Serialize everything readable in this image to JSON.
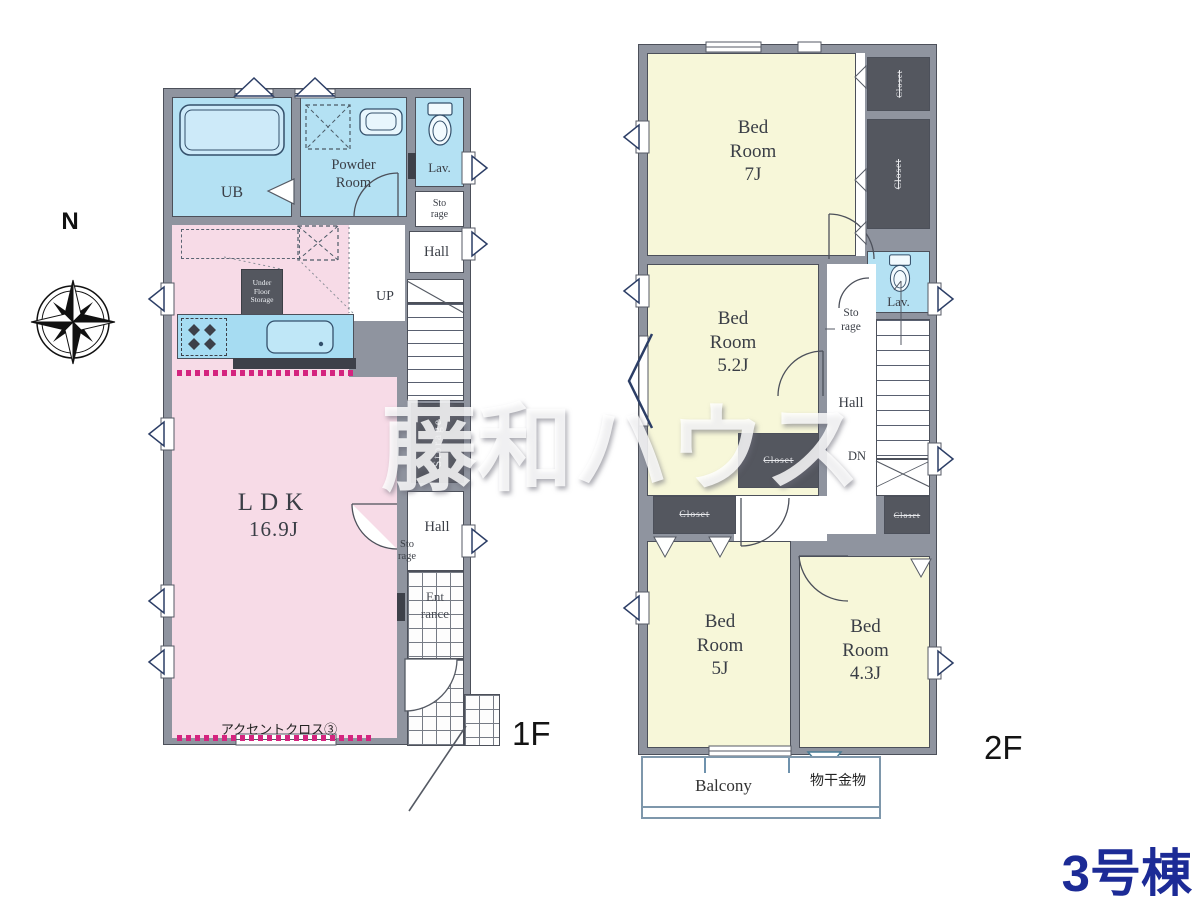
{
  "compass": {
    "north_label": "N"
  },
  "watermark": {
    "text": "藤和ハウス"
  },
  "title": {
    "text": "3号棟"
  },
  "colors": {
    "ldk_pink": "#f7dbe7",
    "wet_area_blue": "#b4e1f3",
    "bedroom_yellow": "#f7f7d9",
    "closet_dark": "#54575f",
    "wall_gray": "#8f949f",
    "accent_magenta": "#d4247f",
    "title_navy": "#1c2b96",
    "balcony_outline": "#7e97ab"
  },
  "floor1": {
    "floor_label": "1F",
    "ub_label": "UB",
    "powder_label": "Powder\nRoom",
    "lav_label": "Lav.",
    "storage_upper_label": "Sto\nrage",
    "hall_upper_label": "Hall",
    "under_floor_label": "Under\nFloor\nStorage",
    "up_label": "UP",
    "stair_storage_label": "Storage",
    "ldk_label": "LDK",
    "ldk_size": "16.9J",
    "hall_lower_label": "Hall",
    "storage_lower_label": "Sto\nrage",
    "entrance_label": "Ent\nrance",
    "accent_label": "アクセントクロス③"
  },
  "floor2": {
    "floor_label": "2F",
    "bedroom_7j": {
      "name": "Bed\nRoom",
      "size": "7J"
    },
    "bedroom_52j": {
      "name": "Bed\nRoom",
      "size": "5.2J"
    },
    "bedroom_5j": {
      "name": "Bed\nRoom",
      "size": "5J"
    },
    "bedroom_43j": {
      "name": "Bed\nRoom",
      "size": "4.3J"
    },
    "closet_top": "Closet",
    "closet_right": "Closet",
    "closet_mid": "Closet",
    "closet_left": "Closet",
    "closet_small": "Closet",
    "lav_label": "Lav.",
    "storage_label": "Sto\nrage",
    "hall_label": "Hall",
    "dn_label": "DN",
    "balcony_label": "Balcony",
    "drying_label": "物干金物"
  }
}
